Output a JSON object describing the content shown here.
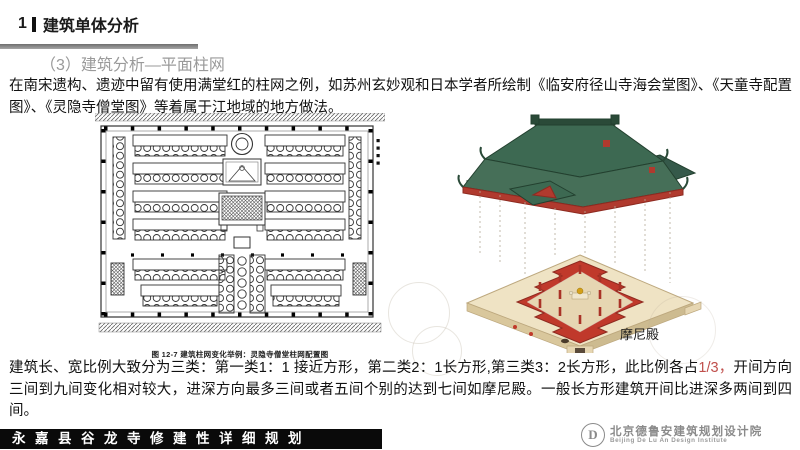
{
  "header": {
    "number": "1",
    "title": "建筑单体分析"
  },
  "subtitle": "（3）建筑分析—平面柱网",
  "body1": "在南宋遗构、遗迹中留有使用满堂红的柱网之例，如苏州玄妙观和日本学者所绘制《临安府径山寺海会堂图》、《天童寺配置图》、《灵隐寺僧堂图》等着属于江地域的地方做法。",
  "figures": {
    "plan": {
      "caption": "图 12-7  建筑柱网变化举例：灵隐寺僧堂柱网配置图"
    },
    "temple": {
      "label": "摩尼殿"
    }
  },
  "body2": {
    "part1": "建筑长、宽比例大致分为三类：第一类1：1 接近方形，第二类2：1长方形,第三类3：2长方形，此比例各占",
    "highlight": "1/3，",
    "part2": "开间方向三间到九间变化相对较大，进深方向最多三间或者五间个别的达到七间如摩尼殿。一般长方形建筑开间比进深多两间到四间。"
  },
  "footer": {
    "title": "永嘉县谷龙寺修建性详细规划",
    "logo_letter": "D",
    "logo_cn": "北京德鲁安建筑规划设计院",
    "logo_en": "Beijing De Lu An Design Institute"
  },
  "colors": {
    "highlight_red": "#c0504d",
    "roof_green": "#3d6952",
    "wall_red": "#c0392b",
    "platform_tan": "#efe3c4",
    "divider_gray": "#8c8c8c",
    "subtitle_gray": "#9a9a9a",
    "footer_black": "#0a0a0a"
  }
}
